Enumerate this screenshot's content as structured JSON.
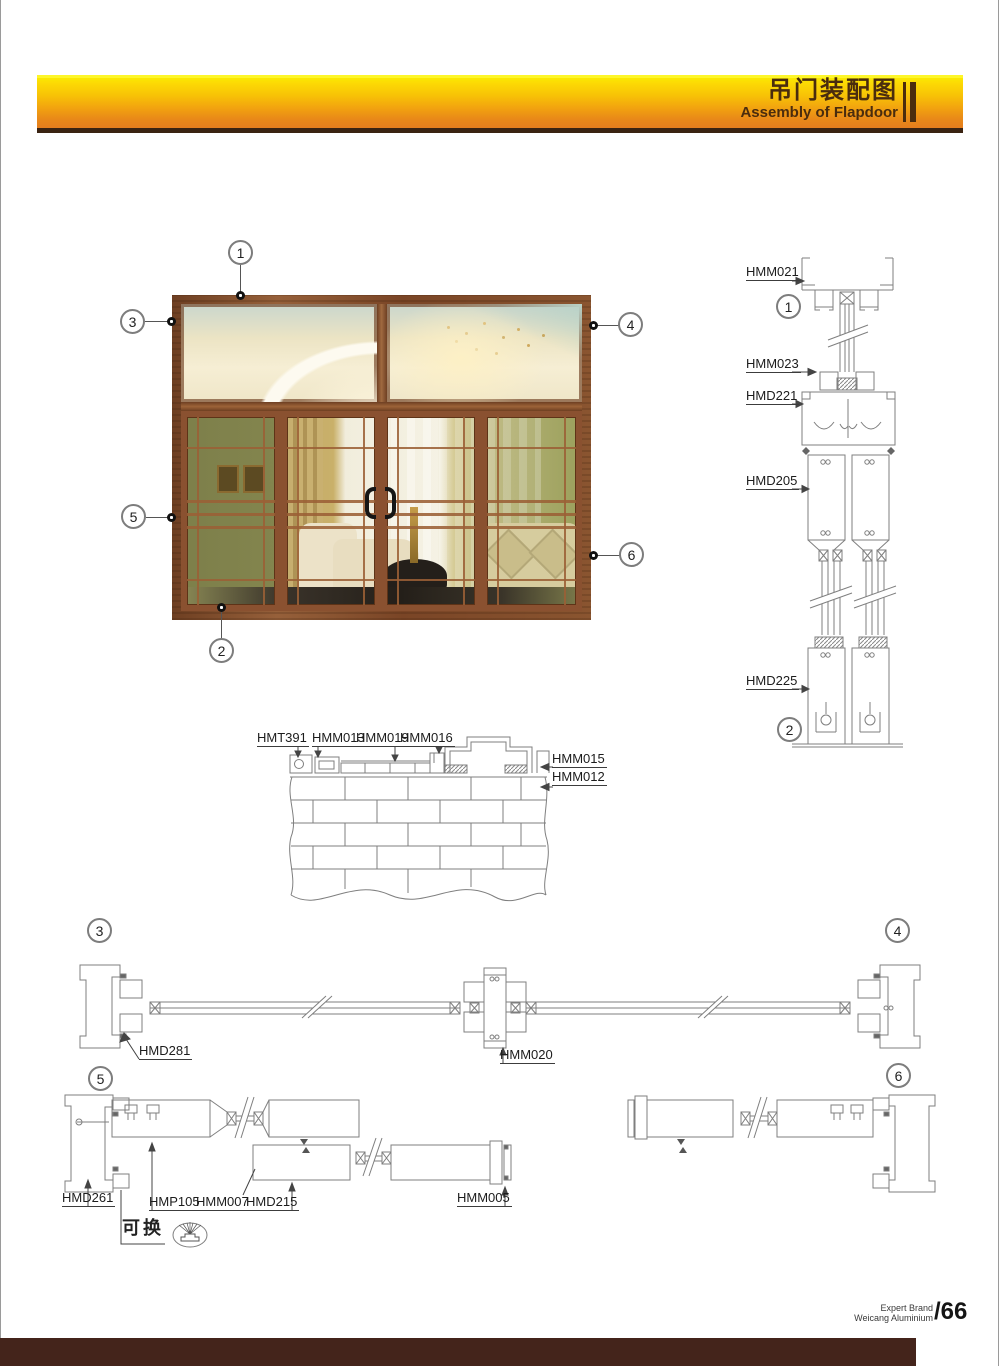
{
  "header": {
    "title_zh": "吊门装配图",
    "title_en": "Assembly of Flapdoor"
  },
  "callouts": {
    "n1": "1",
    "n2": "2",
    "n3": "3",
    "n4": "4",
    "n5": "5",
    "n6": "6"
  },
  "labels": {
    "hmm021": "HMM021",
    "hmm023": "HMM023",
    "hmd221": "HMD221",
    "hmd205": "HMD205",
    "hmd225": "HMD225",
    "hmt391": "HMT391",
    "hmm013": "HMM013",
    "hmm019": "HMM019",
    "hmm016": "HMM016",
    "hmm015": "HMM015",
    "hmm012": "HMM012",
    "hmd281": "HMD281",
    "hmm020": "HMM020",
    "hmd261": "HMD261",
    "hmp105": "HMP105",
    "hmm007": "HMM007",
    "hmd215": "HMD215",
    "hmm005": "HMM005"
  },
  "notes": {
    "replaceable": "可换"
  },
  "footer": {
    "brand_line1": "Expert Brand",
    "brand_line2": "Weicang Aluminium",
    "page_number": "/66"
  },
  "colors": {
    "banner_yellow": "#fcd904",
    "banner_orange": "#e57d1e",
    "banner_text": "#4a2c0e",
    "bar_brown": "#44241b",
    "line_gray": "#7f7f7f"
  }
}
